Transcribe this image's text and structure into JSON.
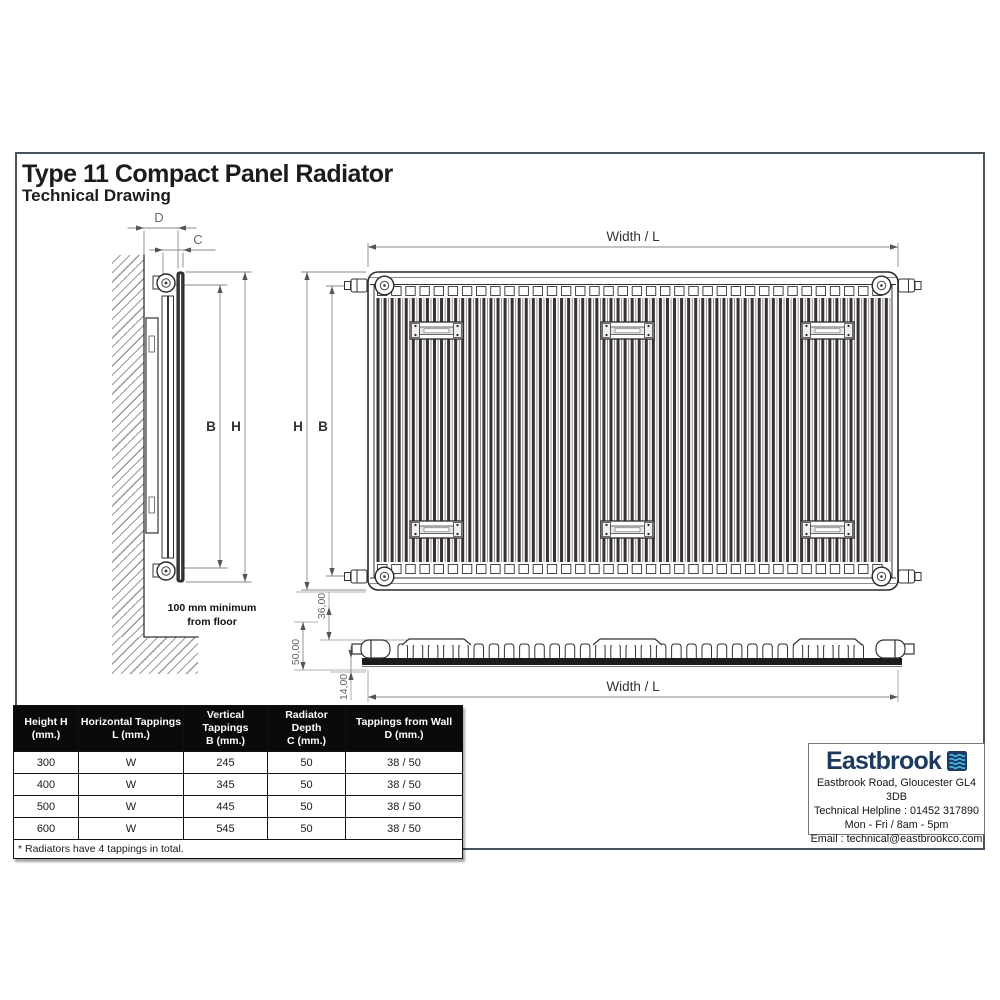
{
  "page": {
    "title": "Type 11 Compact Panel Radiator",
    "subtitle": "Technical Drawing"
  },
  "drawing": {
    "side": {
      "dim_d": "D",
      "dim_c": "C",
      "dim_b": "B",
      "dim_h": "H",
      "floor_note_line1": "100 mm minimum",
      "floor_note_line2": "from floor"
    },
    "front": {
      "width_label": "Width / L",
      "dim_h": "H",
      "dim_b": "B"
    },
    "profile": {
      "dim_36": "36,00",
      "dim_50": "50,00",
      "dim_14": "14,00",
      "width_label": "Width / L"
    }
  },
  "table": {
    "headers": [
      {
        "line1": "Height H",
        "line2": "(mm.)"
      },
      {
        "line1": "Horizontal Tappings",
        "line2": "L (mm.)"
      },
      {
        "line1": "Vertical Tappings",
        "line2": "B (mm.)"
      },
      {
        "line1": "Radiator Depth",
        "line2": "C (mm.)"
      },
      {
        "line1": "Tappings from Wall",
        "line2": "D (mm.)"
      }
    ],
    "rows": [
      [
        "300",
        "W",
        "245",
        "50",
        "38 / 50"
      ],
      [
        "400",
        "W",
        "345",
        "50",
        "38 / 50"
      ],
      [
        "500",
        "W",
        "445",
        "50",
        "38 / 50"
      ],
      [
        "600",
        "W",
        "545",
        "50",
        "38 / 50"
      ]
    ],
    "footnote": "* Radiators have 4 tappings in total."
  },
  "brand": {
    "name": "Eastbrook",
    "address": "Eastbrook Road, Gloucester GL4 3DB",
    "helpline": "Technical Helpline : 01452 317890",
    "hours": "Mon - Fri / 8am - 5pm",
    "email": "Email : technical@eastbrookco.com",
    "logo_navy": "#1e3a5f",
    "logo_wave_blue": "#45b8e8"
  },
  "colors": {
    "page_border": "#47525c",
    "drawing_line": "#2a2a2a",
    "dimension_gray": "#777777",
    "table_header_bg": "#0a0a0a"
  }
}
